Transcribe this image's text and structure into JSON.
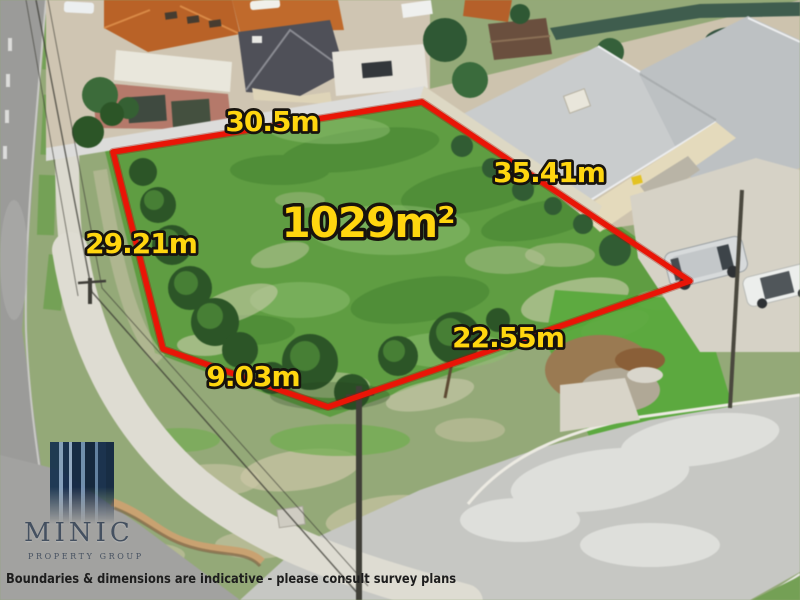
{
  "photo": {
    "type": "aerial-photo",
    "subject": "vacant residential land lot outlined in red among suburban houses and streets"
  },
  "annotations": {
    "boundary_color": "#e91507",
    "label_color": "#ffd60f",
    "area_label": "1029m²",
    "dimensions": [
      {
        "side": "top",
        "label": "30.5m"
      },
      {
        "side": "right",
        "label": "35.41m"
      },
      {
        "side": "left",
        "label": "29.21m"
      },
      {
        "side": "bottom-right",
        "label": "22.55m"
      },
      {
        "side": "bottom-left",
        "label": "9.03m"
      }
    ]
  },
  "branding": {
    "name": "MINIC",
    "tagline": "PROPERTY GROUP",
    "logo_color": "#12294b"
  },
  "disclaimer": "Boundaries & dimensions are indicative - please consult survey plans"
}
